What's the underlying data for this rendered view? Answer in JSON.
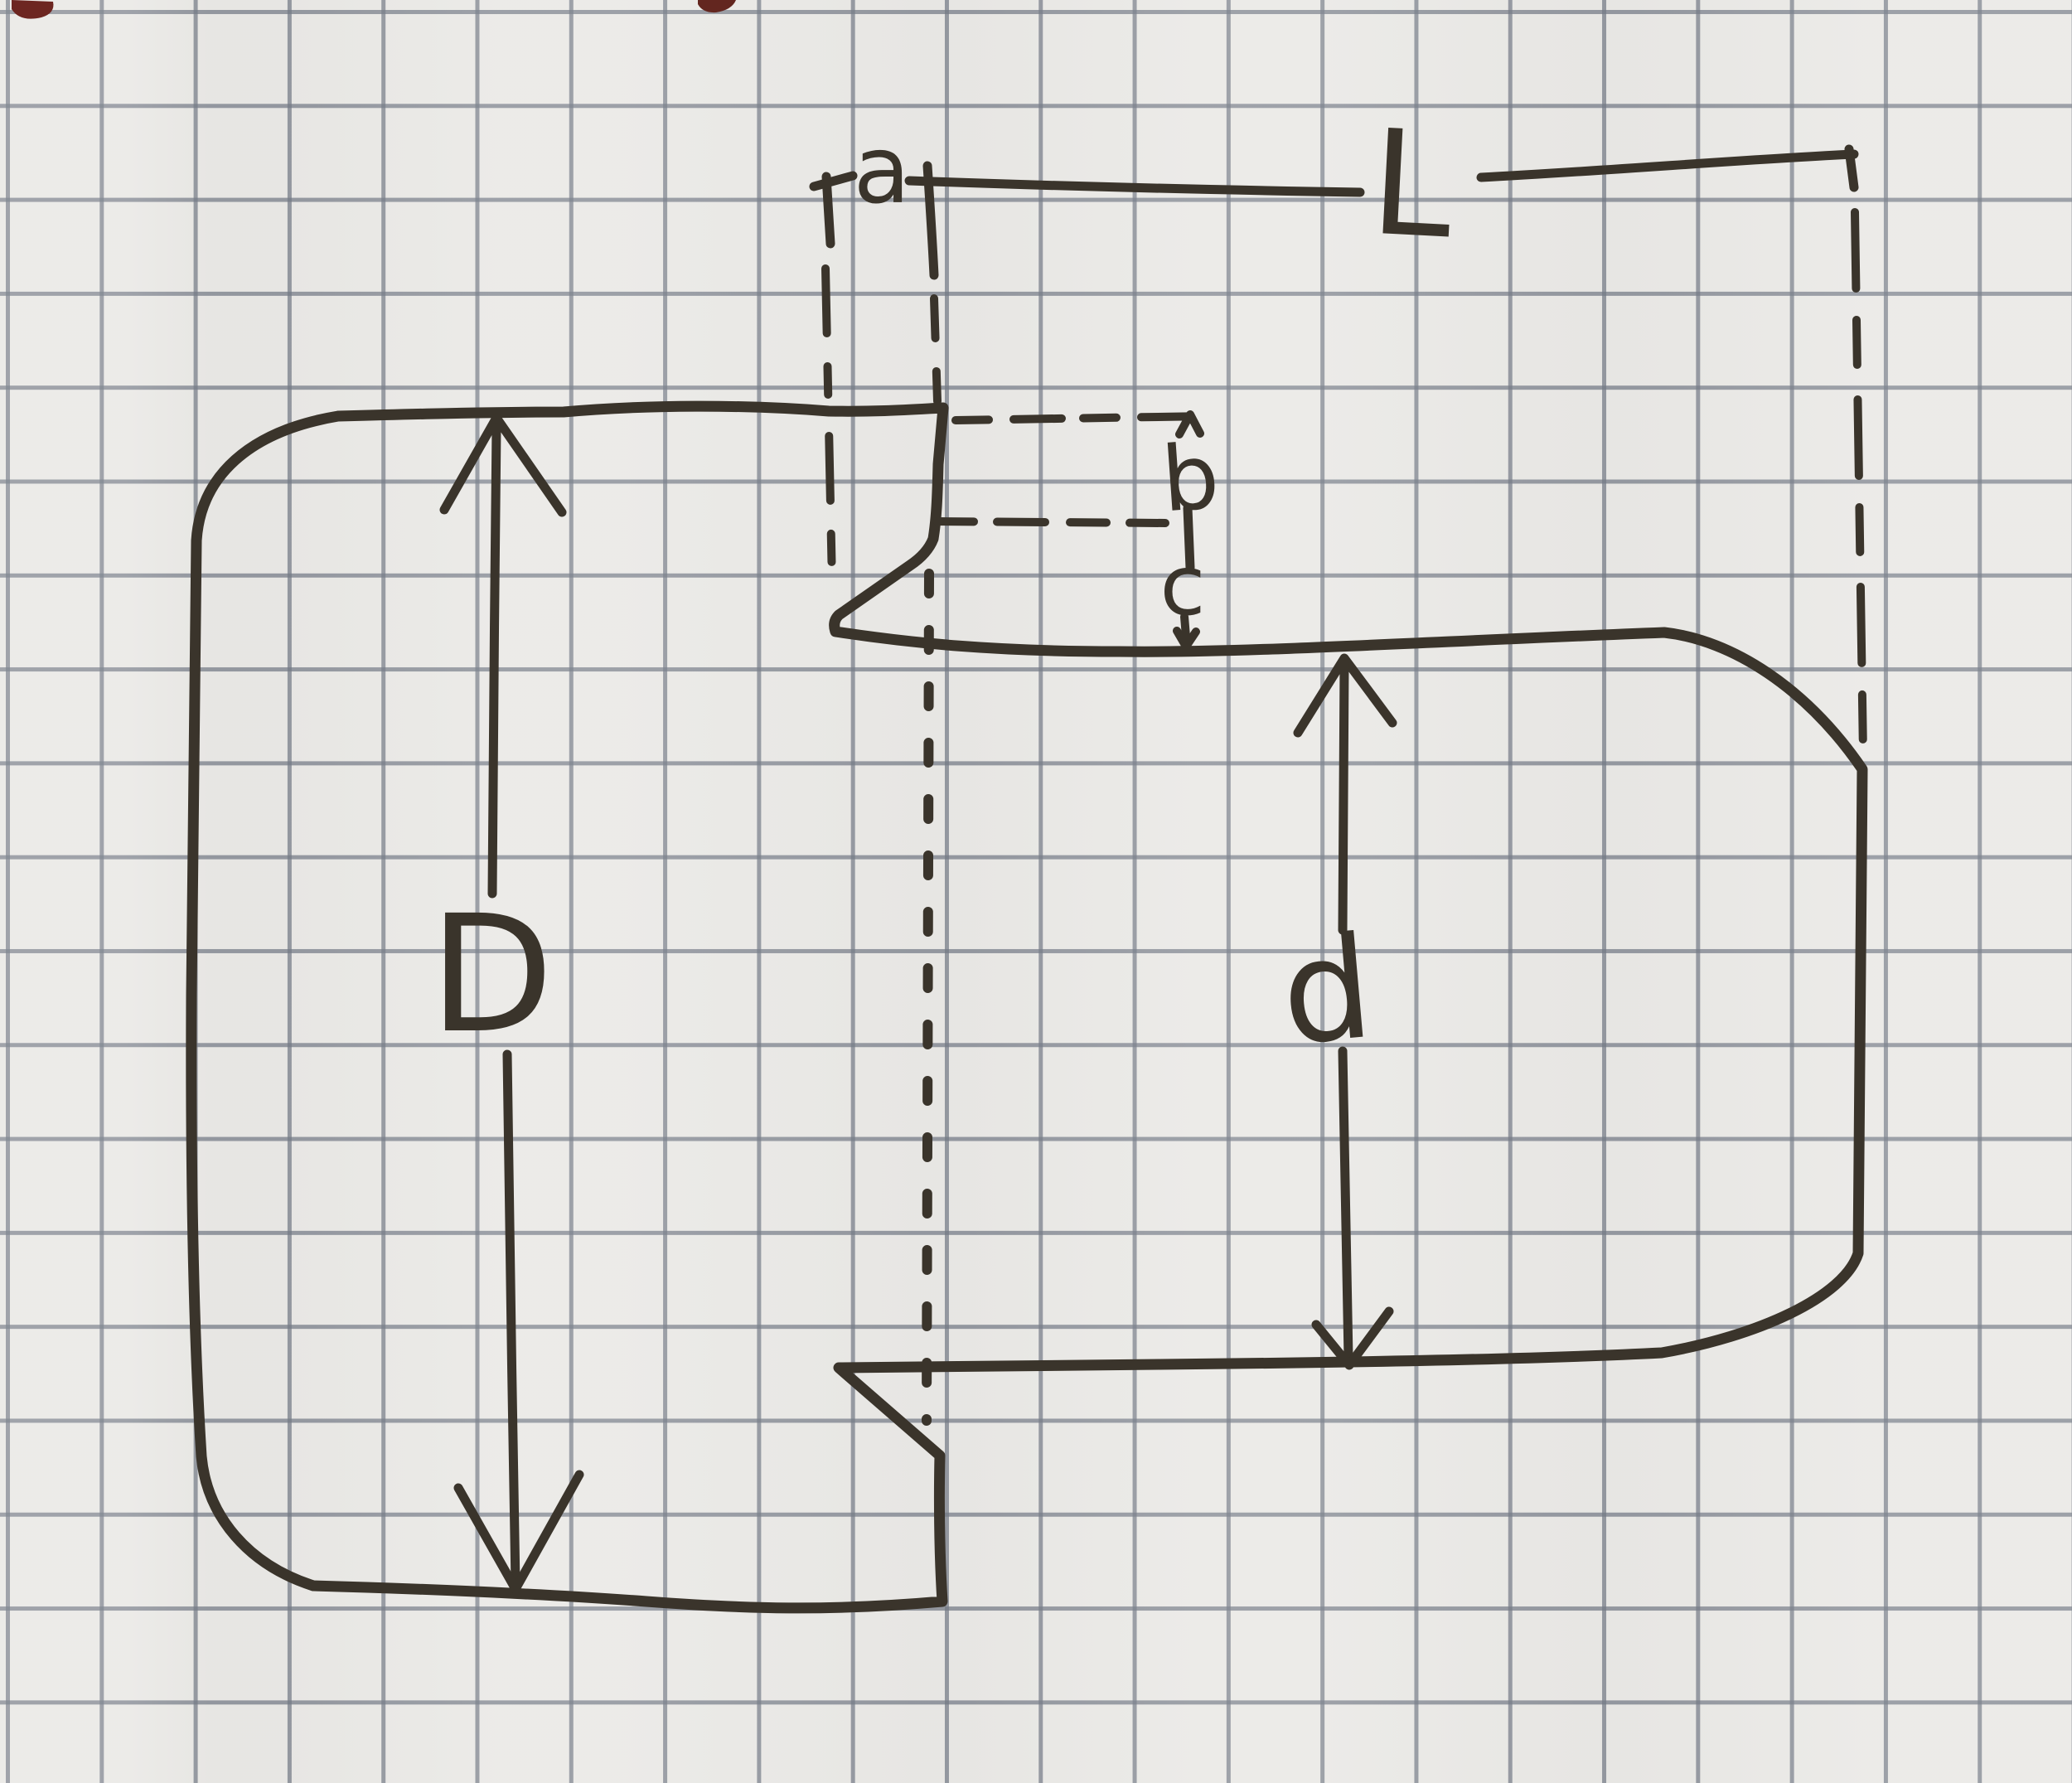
{
  "figure": {
    "kind": "hand-drawn dimension sketch on squared graph paper",
    "subject": "stepped shaft outline with relief grooves at the shoulder"
  },
  "labels": {
    "D": "D",
    "d": "d",
    "L": "L",
    "a": "a",
    "b": "b",
    "c": "c"
  },
  "colors": {
    "ink": "#3a342b",
    "paper": "#eae9e6",
    "grid_line": "#9aa0aa",
    "red_ink_marks": "#6d2621"
  }
}
